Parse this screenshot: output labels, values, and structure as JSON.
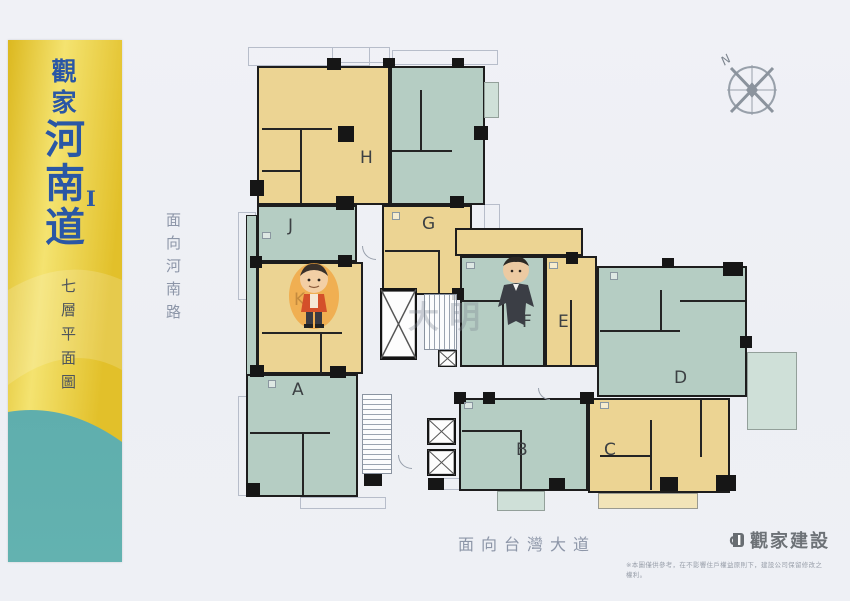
{
  "banner": {
    "brand_line1": "觀家",
    "brand_line2": "河南道",
    "brand_suffix": "I",
    "floor_plan_label": "七層平面圖"
  },
  "streets": {
    "left_vertical": "面向河南路",
    "bottom_horizontal": "面向台灣大道"
  },
  "compass": {
    "north_label": "N"
  },
  "watermark": {
    "text": "大明"
  },
  "units": [
    {
      "label": "A",
      "fill": "teal"
    },
    {
      "label": "B",
      "fill": "teal"
    },
    {
      "label": "C",
      "fill": "yellow"
    },
    {
      "label": "D",
      "fill": "teal"
    },
    {
      "label": "E",
      "fill": "yellow"
    },
    {
      "label": "F",
      "fill": "teal"
    },
    {
      "label": "G",
      "fill": "yellow"
    },
    {
      "label": "H",
      "fill": "yellow"
    },
    {
      "label": "J",
      "fill": "teal"
    },
    {
      "label": "K",
      "fill": "yellow"
    }
  ],
  "footer": {
    "builder_logo_text": "觀家建設",
    "disclaimer": "※本圖僅供參考，在不影響住戶權益原則下，建設公司保留修改之權利。"
  },
  "colors": {
    "unit_yellow": "#ecd493",
    "unit_teal": "#b5cdc3",
    "wall_black": "#1d1d1d",
    "brand_blue": "#2a57a5",
    "banner_yellow": "#e8c832",
    "banner_teal": "#58a8a8",
    "street_text": "#8d96a8",
    "logo_gray": "#6d7277"
  }
}
